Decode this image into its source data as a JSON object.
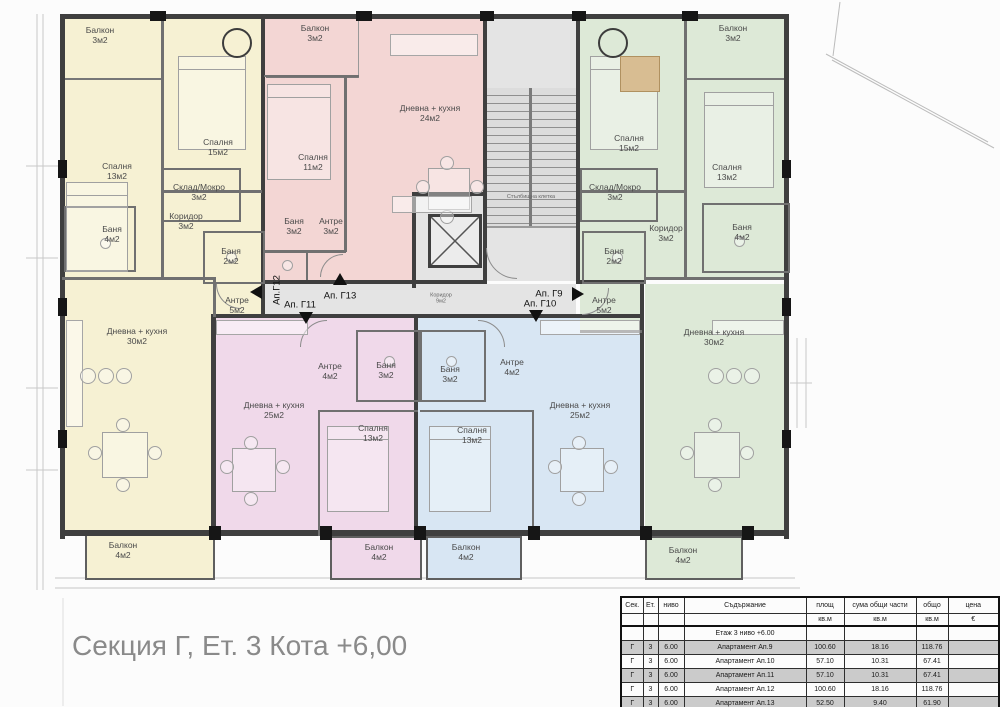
{
  "title": "Секция Г, Ет. 3 Кота +6,00",
  "colors": {
    "wall": "#3f3f3f",
    "ap-yellow": "#f6f1d3",
    "ap-pink": "#f3d6d4",
    "ap-magenta": "#f0d9ea",
    "ap-blue": "#d8e6f3",
    "ap-green": "#dde9d7",
    "hall": "#e4e4e4"
  },
  "plan": {
    "rooms": {
      "y_balkon_top": "Балкон\n3м2",
      "y_spalnya15": "Спалня\n15м2",
      "y_spalnya13": "Спалня\n13м2",
      "y_sklad": "Склад/Мокро\n3м2",
      "y_koridor": "Коридор\n3м2",
      "y_banya4": "Баня\n4м2",
      "y_banya2": "Баня\n2м2",
      "y_antre": "Антре\n5м2",
      "y_dnevna": "Дневна + кухня\n30м2",
      "y_balkon_bot": "Балкон\n4м2",
      "p_balkon": "Балкон\n3м2",
      "p_spalnya": "Спалня\n11м2",
      "p_dnevna": "Дневна + кухня\n24м2",
      "p_banya": "Баня\n3м2",
      "p_antre": "Антре\n3м2",
      "g_balkon_top": "Балкон\n3м2",
      "g_spalnya15": "Спалня\n15м2",
      "g_spalnya13": "Спалня\n13м2",
      "g_sklad": "Склад/Мокро\n3м2",
      "g_koridor": "Коридор\n3м2",
      "g_banya2": "Баня\n2м2",
      "g_banya4": "Баня\n4м2",
      "g_antre": "Антре\n5м2",
      "g_dnevna": "Дневна + кухня\n30м2",
      "g_balkon_bot": "Балкон\n4м2",
      "m_antre": "Антре\n4м2",
      "m_banya": "Баня\n3м2",
      "m_dnevna": "Дневна + кухня\n25м2",
      "m_spalnya": "Спалня\n13м2",
      "m_balkon": "Балкон\n4м2",
      "b_banya": "Баня\n3м2",
      "b_antre": "Антре\n4м2",
      "b_dnevna": "Дневна + кухня\n25м2",
      "b_spalnya": "Спалня\n13м2",
      "b_balkon": "Балкон\n4м2",
      "stair": "Стълбищна клетка",
      "hall_koridor": "Коридор\n9м2"
    },
    "tags": {
      "g12": "Ап.Г12",
      "g13": "Ап. Г13",
      "g11": "Ап. Г11",
      "g9": "Ап. Г9",
      "g10": "Ап. Г10"
    }
  },
  "table": {
    "headers": [
      "Сек.",
      "Ет.",
      "ниво",
      "Съдържание",
      "площ",
      "сума общи части",
      "общо",
      "цена"
    ],
    "units": [
      "",
      "",
      "",
      "",
      "кв.м",
      "кв.м",
      "кв.м",
      "€"
    ],
    "section_label": "Етаж 3 ниво +6.00",
    "rows": [
      [
        "Г",
        "3",
        "6.00",
        "Апартамент Ап.9",
        "100.60",
        "18.16",
        "118.76",
        ""
      ],
      [
        "Г",
        "3",
        "6.00",
        "Апартамент Ап.10",
        "57.10",
        "10.31",
        "67.41",
        ""
      ],
      [
        "Г",
        "3",
        "6.00",
        "Апартамент Ап.11",
        "57.10",
        "10.31",
        "67.41",
        ""
      ],
      [
        "Г",
        "3",
        "6.00",
        "Апартамент Ап.12",
        "100.60",
        "18.16",
        "118.76",
        ""
      ],
      [
        "Г",
        "3",
        "6.00",
        "Апартамент Ап.13",
        "52.50",
        "9.40",
        "61.90",
        ""
      ]
    ]
  }
}
